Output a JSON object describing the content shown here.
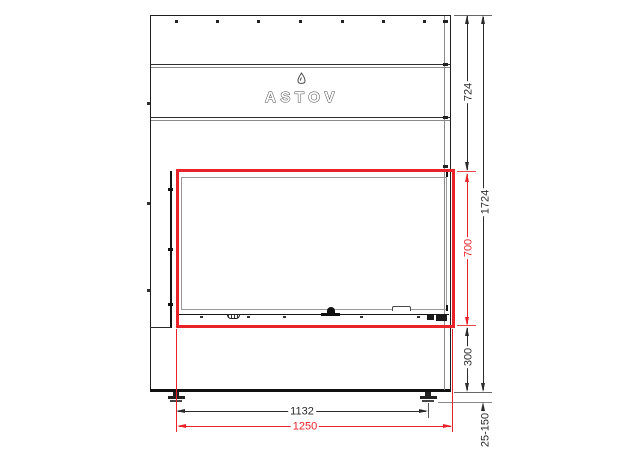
{
  "logo": {
    "text": "ASTOV"
  },
  "dimensions": {
    "right": {
      "top_section_height": "724",
      "opening_height": "700",
      "base_height": "300",
      "total_height": "1724",
      "feet_adjustment_range": "25-150"
    },
    "bottom": {
      "feet_spacing": "1132",
      "opening_width": "1250"
    }
  },
  "colors": {
    "highlight_red": "#e8232a",
    "line_black": "#2b2b2b",
    "line_gray": "#9a9a9a"
  }
}
